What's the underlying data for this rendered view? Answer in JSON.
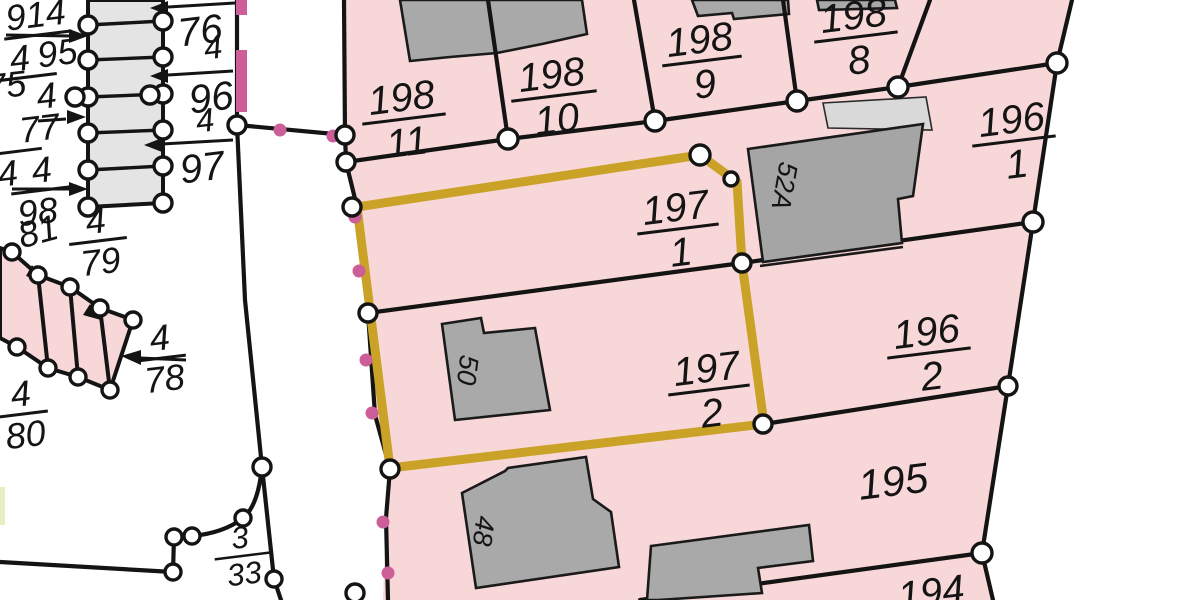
{
  "map": {
    "type": "cadastral-parcel-map",
    "highlighted_parcel": "197/1 + 197/2",
    "colors": {
      "parcel_fill": "#f8d7d8",
      "highlight_outline": "#c9a227",
      "building_fill": "#a9a9a9",
      "building_light_fill": "#d9d9d9",
      "garage_strip_fill": "#e4e4e4",
      "boundary_line": "#141414",
      "point_marker_fill": "#ffffff",
      "pink_marker": "#cc5f99",
      "sliver_fill": "#e9edc4"
    }
  },
  "fractions": [
    {
      "id": "198-11",
      "num": "198",
      "den": "11"
    },
    {
      "id": "198-10",
      "num": "198",
      "den": "10"
    },
    {
      "id": "198-9",
      "num": "198",
      "den": "9"
    },
    {
      "id": "198-8",
      "num": "198",
      "den": "8"
    },
    {
      "id": "196-1",
      "num": "196",
      "den": "1"
    },
    {
      "id": "197-1",
      "num": "197",
      "den": "1"
    },
    {
      "id": "197-2",
      "num": "197",
      "den": "2"
    },
    {
      "id": "196-2",
      "num": "196",
      "den": "2"
    },
    {
      "id": "4-79",
      "num": "4",
      "den": "79"
    },
    {
      "id": "4-78",
      "num": "4",
      "den": "78"
    },
    {
      "id": "4-80",
      "num": "4",
      "den": "80"
    },
    {
      "id": "3-33",
      "num": "3",
      "den": "33"
    },
    {
      "id": "914-4",
      "num": "914",
      "den": "4"
    },
    {
      "id": "95-4",
      "num": "95",
      "den": "4"
    },
    {
      "id": "77-4",
      "num": "77",
      "den": "4"
    },
    {
      "id": "4-98",
      "num": "4",
      "den": "98"
    }
  ],
  "labels": [
    {
      "id": "75",
      "text": "75"
    },
    {
      "id": "81",
      "text": "81"
    },
    {
      "id": "76",
      "text": "76"
    },
    {
      "id": "76-4",
      "text": "4"
    },
    {
      "id": "96",
      "text": "96"
    },
    {
      "id": "96-4",
      "text": "4"
    },
    {
      "id": "97",
      "text": "97"
    },
    {
      "id": "195",
      "text": "195"
    },
    {
      "id": "194",
      "text": "194"
    },
    {
      "id": "house-50",
      "text": "50"
    },
    {
      "id": "house-48",
      "text": "48"
    },
    {
      "id": "house-52a",
      "text": "52A"
    }
  ]
}
